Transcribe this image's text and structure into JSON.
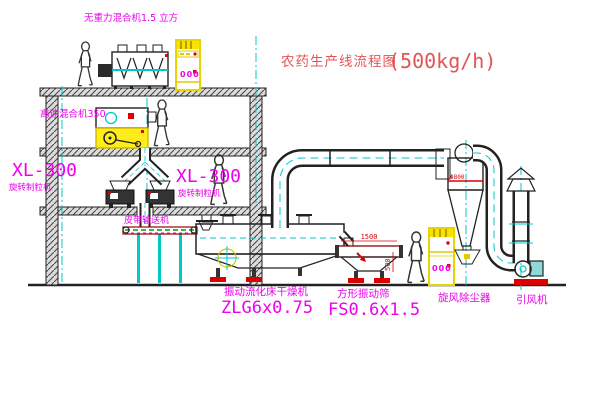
{
  "title": {
    "text": "农药生产线流程图",
    "capacity": "(500kg/h)",
    "color": "#e25555"
  },
  "labels": {
    "gravity_mixer": "无重力混合机1.5 立方",
    "high_speed_mixer": "高速混合机350",
    "granulator_left_model": "XL-300",
    "granulator_left_name": "旋转制粒机",
    "granulator_right_model": "XL-300",
    "granulator_right_name": "旋转制粒机",
    "belt_conveyor": "皮带输送机",
    "dryer_name": "振动流化床干燥机",
    "dryer_model": "ZLG6x0.75",
    "sieve_name": "方形振动筛",
    "sieve_model": "FS0.6x1.5",
    "cyclone": "旋风除尘器",
    "fan": "引风机"
  },
  "dimensions": {
    "sieve_length": "1500",
    "sieve_height": "500",
    "cyclone_marking": "Φ800"
  },
  "panels": {
    "display": "000"
  },
  "colors": {
    "line": "#222222",
    "cyan": "#00c8c8",
    "magenta": "#ee00ee",
    "red": "#e00000",
    "yellow": "#f6e400",
    "green": "#00a000",
    "title_red": "#e25555",
    "background": "#ffffff"
  }
}
